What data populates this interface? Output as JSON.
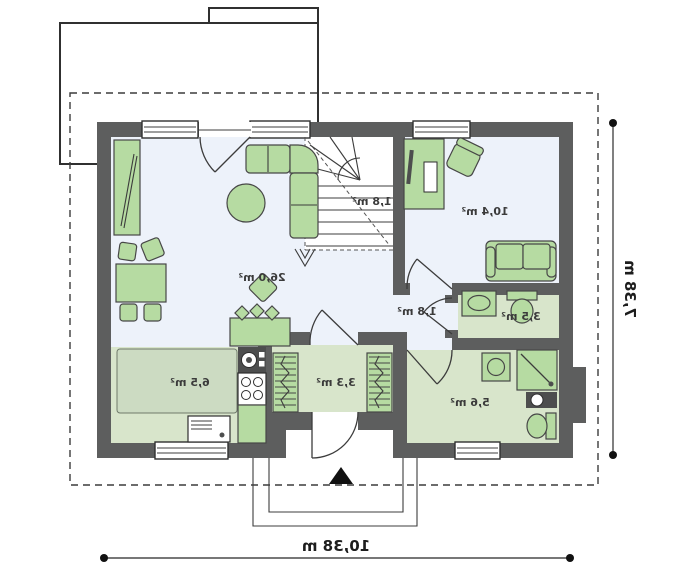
{
  "colors": {
    "wall": "#5d5e5e",
    "furn": "#b6dba2",
    "furnstroke": "#474747",
    "floorb": "#edf2fa",
    "floorg": "#d8e5cb",
    "floorg2": "#ccdbc2",
    "line": "#3c3c3c",
    "text": "#3b3b3b"
  },
  "rooms": {
    "living": {
      "name": "living-room",
      "area": "26,0 m²"
    },
    "stairs": {
      "name": "staircase",
      "area": "1,8 m²"
    },
    "study": {
      "name": "study",
      "area": "10,4 m²"
    },
    "hall": {
      "name": "hall",
      "area": "1,8 m²"
    },
    "wc": {
      "name": "wc",
      "area": "3,5 m²"
    },
    "kitchen": {
      "name": "kitchen",
      "area": "6,5 m²"
    },
    "entry": {
      "name": "entry",
      "area": "3,3 m²"
    },
    "bath": {
      "name": "bathroom",
      "area": "5,6 m²"
    }
  },
  "dimensions": {
    "width": "10,38 m",
    "depth": "7,38 m"
  }
}
